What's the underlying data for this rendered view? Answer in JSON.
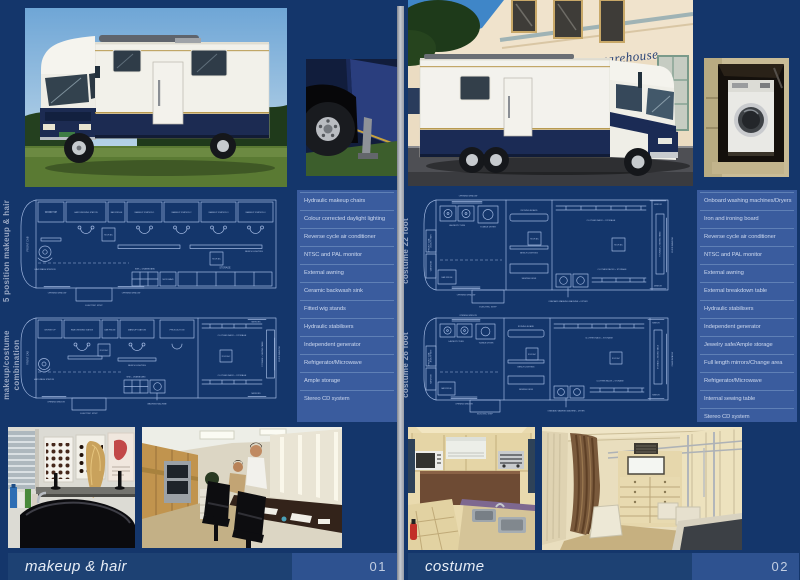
{
  "colors": {
    "page_bg": "#14366B",
    "panel": "#3A5C9E",
    "panel_line": "#5F80B6",
    "panel_text": "#CBD7EE",
    "blueprint_line": "#9FB6DF",
    "title_bar": "#1D4173",
    "number_box": "#2E5290",
    "title_text": "#E7EDF6",
    "vertical_label": "#98A6C2",
    "gutter": "#C6CAD1"
  },
  "left_page": {
    "section_labels": [
      "5 position makeup & hair",
      "makeup/costume combination"
    ],
    "features": [
      "Hydraulic makeup chairs",
      "Colour corrected daylight lighting",
      "Reverse cycle air conditioner",
      "NTSC and PAL monitor",
      "External awning",
      "Ceramic backwash sink",
      "Fitted wig stands",
      "Hydraulic stabilisers",
      "Independent generator",
      "Refrigerator/Microwave",
      "Ample storage",
      "Stereo CD system"
    ],
    "title": "makeup & hair",
    "page_number": "01"
  },
  "right_page": {
    "section_labels": [
      "costume 22 foot",
      "costume 26 foot"
    ],
    "features": [
      "Onboard washing machines/Dryers",
      "Iron and ironing board",
      "Reverse cycle air conditioner",
      "NTSC and PAL monitor",
      "External awning",
      "External breakdown table",
      "Hydraulic stabilisers",
      "Independent generator",
      "Jewelry safe/Ample storage",
      "Full length mirrors/Change area",
      "Refrigerator/Microwave",
      "Internal sewing table",
      "Stereo CD system"
    ],
    "title": "costume",
    "page_number": "02",
    "photo_sign": "costume warehouse"
  },
  "blueprints": {
    "plan1": {
      "front_cab": "FRONT CAB",
      "worktop": "WORKTOP",
      "hair_dressing": "HAIR DRESSING STATION",
      "bar_fridge": "BAR FRIDGE",
      "station1": "MAKEUP STATION 1",
      "station2": "MAKEUP STATION 2",
      "station3": "MAKEUP STATION 3",
      "station4": "MAKEUP STATION 4",
      "roof_ac": "ROOF A/C",
      "bench_lighting": "BENCH LIGHTING",
      "hair_wash": "HAIR WASH STATION",
      "sink": "SINK + DRAINBOARD",
      "microwave": "MICROWAVE",
      "storage": "STORAGE",
      "opening_window": "OPENING WINDOW",
      "electric_step": "ELECTRIC STEP"
    },
    "plan2": {
      "front_cab": "FRONT CAB",
      "worktop": "WORKTOP",
      "hair_dressing": "HAIR DRESSING STATION",
      "bar_fridge": "BAR FRIDGE",
      "makeup_station": "MAKEUP STATION",
      "production": "PRODUCTION",
      "clothes_rack": "CLOTHES RACK + STORAGE",
      "roof_ac": "ROOF A/C",
      "bench_lighting": "BENCH LIGHTING",
      "hair_wash": "HAIR WASH STATION",
      "sink": "SINK + DRAINBOARD",
      "washing_machine": "WASHING MACHINE",
      "electric_step": "ELECTRIC STEP",
      "opening_window": "OPENING WINDOW",
      "mirrors": "MIRRORS",
      "sewing_table": "STORAGE + SEWING TABLE",
      "fixed_window": "FIXED WINDOW"
    },
    "plan3": {
      "front_cab": "FRONT CAB",
      "opening_window_top": "OPENING WINDOW",
      "laundry_tubs": "LAUNDRY TUBS",
      "tumble_dryer": "TUMBLE DRYER",
      "jewelry_safe": "JEWELRY SAFE",
      "wardrobe": "WARDROBE",
      "bar_fridge": "BAR FRIDGE",
      "ironing_board": "IRONING BOARD",
      "bench_lighting": "BENCH LIGHTING",
      "sewing_desk": "SEWING DESK",
      "clothes_rack_top": "CLOTHES RACK + STORAGE",
      "clothes_rack_bottom": "CLOTHES RACKS + STORAGE",
      "roof_ac": "ROOF A/C",
      "mirror": "MIRROR",
      "sewing_table": "STORAGE + SEWING TABLE",
      "fixed_window": "FIXED WINDOW",
      "washer_dryer": "ONBOARD WASHING MACHINE + DRYER",
      "electric_step": "ELECTRIC STEP",
      "opening_window_bottom": "OPENING WINDOW"
    },
    "plan4": {
      "front_cab": "FRONT CAB",
      "opening_window_top": "OPENING WINDOW",
      "laundry_tubs": "LAUNDRY TUBS",
      "tumble_dryer": "TUMBLE DRYER",
      "jewelry_safe": "JEWELRY SAFE",
      "wardrobe": "WARDROBE",
      "bar_fridge": "BAR FRIDGE",
      "ironing_board": "IRONING BOARD",
      "bench_lighting": "BENCH LIGHTING",
      "sewing_desk": "SEWING DESK",
      "clothes_rack_top": "CLOTHES RACK + STORAGE",
      "clothes_rack_bottom": "CLOTHES RACKS + STORAGE",
      "roof_ac": "ROOF A/C",
      "mirror": "MIRROR",
      "sewing_table": "STORAGE + SEWING TABLE",
      "fixed_window": "FIXED WINDOW",
      "washer_dryer": "ONBOARD WASHING MACHINE + DRYER",
      "electric_step": "ELECTRIC STEP",
      "opening_window_bottom": "OPENING WINDOW"
    }
  }
}
